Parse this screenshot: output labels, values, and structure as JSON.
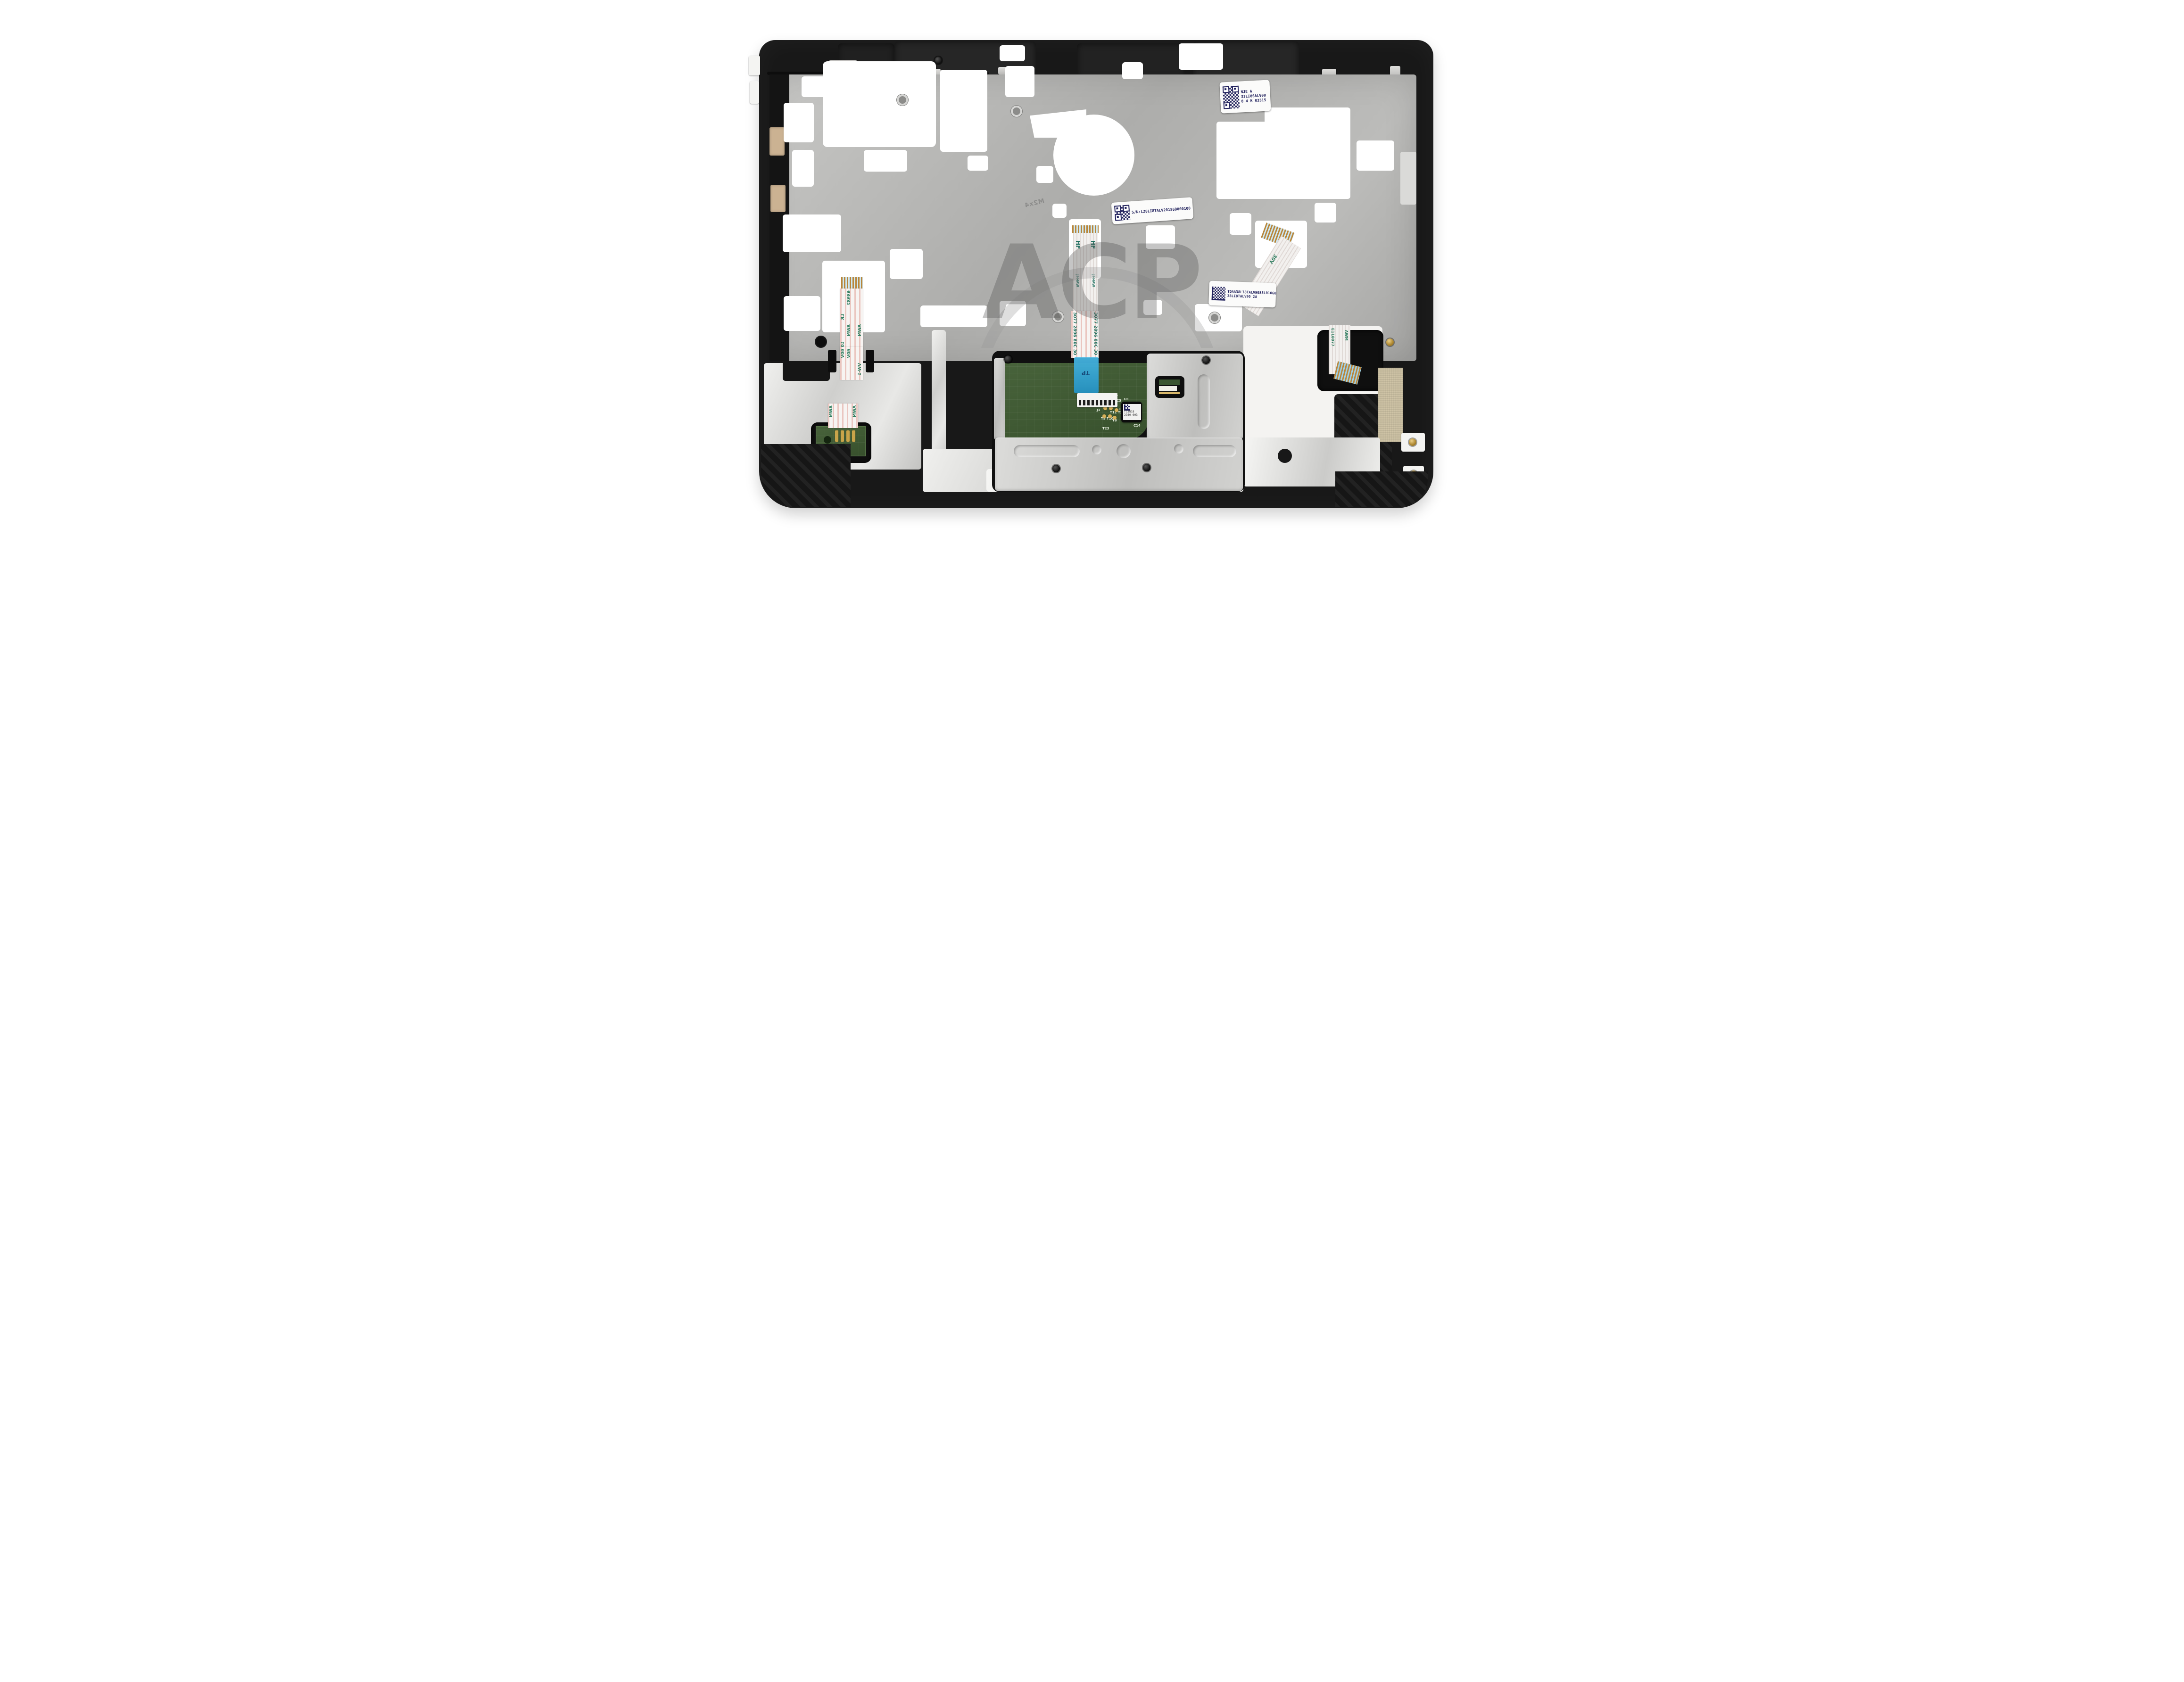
{
  "watermark": {
    "text": "ACP"
  },
  "labels": {
    "speaker": {
      "line1": "NJE A",
      "line2": "3ILI8SALV00",
      "line3": "8 4 K 03315"
    },
    "serial": {
      "text": "S/N:L28LI8TALV20186B000100"
    },
    "module": {
      "line1": "TDAA38LI8TALV9085L01068",
      "line2": "38LI8TALV90 2A"
    }
  },
  "shield": {
    "embossed": "M2x4"
  },
  "touchpad": {
    "chip_line1": "TC3818",
    "chip_line2": "2980-003",
    "silk": {
      "t21": "T21",
      "c3": "C3",
      "u1": "U1",
      "t11": "T11",
      "c2": "C2",
      "r1": "R1",
      "t12": "T12",
      "t20": "T20",
      "t9": "T9",
      "t10": "T10",
      "t8": "T8",
      "t23": "T23",
      "c14": "C14",
      "j1": "J1"
    }
  },
  "small_pcb": {
    "cn1": "CN1"
  },
  "ribbons": {
    "left": {
      "code": "63982",
      "lr": "LR",
      "awm": "AWM",
      "temp": "105C",
      "volt": "60V",
      "vw": "VW-1"
    },
    "keyboard": {
      "hf": "HF",
      "maker": "JI-HAW",
      "nums": "3077 2896 80C 30"
    },
    "tp_tape": {
      "tp": "TP"
    },
    "right": {
      "volt": "30V",
      "code": "E118077",
      "awm": "AWM"
    }
  },
  "colors": {
    "label_ink": "#23235e",
    "ribbon_print_green": "#2e7d5f",
    "pcb_green": "#3d5a30",
    "tape_blue": "#2fa7d9",
    "foil_silver": "#d6d6d4",
    "plastic_black": "#181818",
    "foam_tan": "#cbb292"
  }
}
